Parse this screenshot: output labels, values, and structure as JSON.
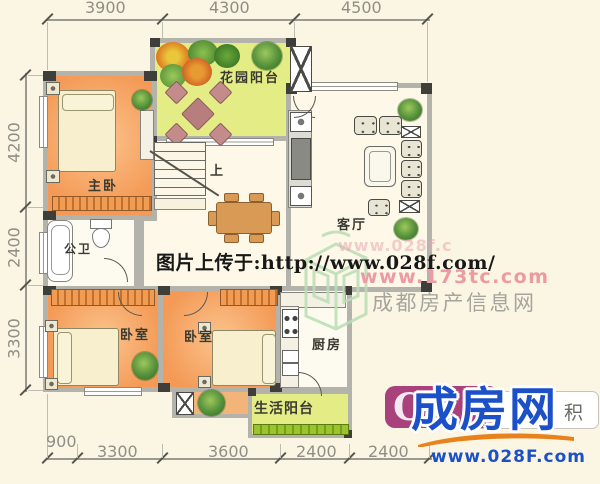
{
  "dimensions": {
    "top": [
      "3900",
      "4300",
      "4500"
    ],
    "left": [
      "4200",
      "2400",
      "3300"
    ],
    "bottom": [
      "900",
      "3300",
      "3600",
      "2400",
      "2400"
    ]
  },
  "rooms": {
    "garden_balcony": "花园阳台",
    "master_bedroom": "主卧",
    "bathroom": "公卫",
    "living_room": "客厅",
    "bedroom_a": "卧室",
    "bedroom_b": "卧室",
    "kitchen": "厨房",
    "service_balcony": "生活阳台",
    "stairs": "上"
  },
  "watermarks": {
    "upload_text": "图片上传于:http://www.028f.com/",
    "site_pink_partial": "www.028f.c",
    "site_pink": "www.173tc.com",
    "site_gray": "成都房产信息网",
    "brand_name": "成房网",
    "brand_url": "www.028F.com",
    "badge_letter": "C",
    "badge_tail": "积"
  },
  "colors": {
    "background": "#fbf5e3",
    "wall_gray": "#b3b3ab",
    "room_orange": "#f49a56",
    "balcony_green": "#e4ed85",
    "brand_blue": "#1b50c8",
    "badge_magenta": "#a8417c",
    "swoosh_orange": "#e8821c",
    "watermark_pink": "#ec9aa4"
  }
}
